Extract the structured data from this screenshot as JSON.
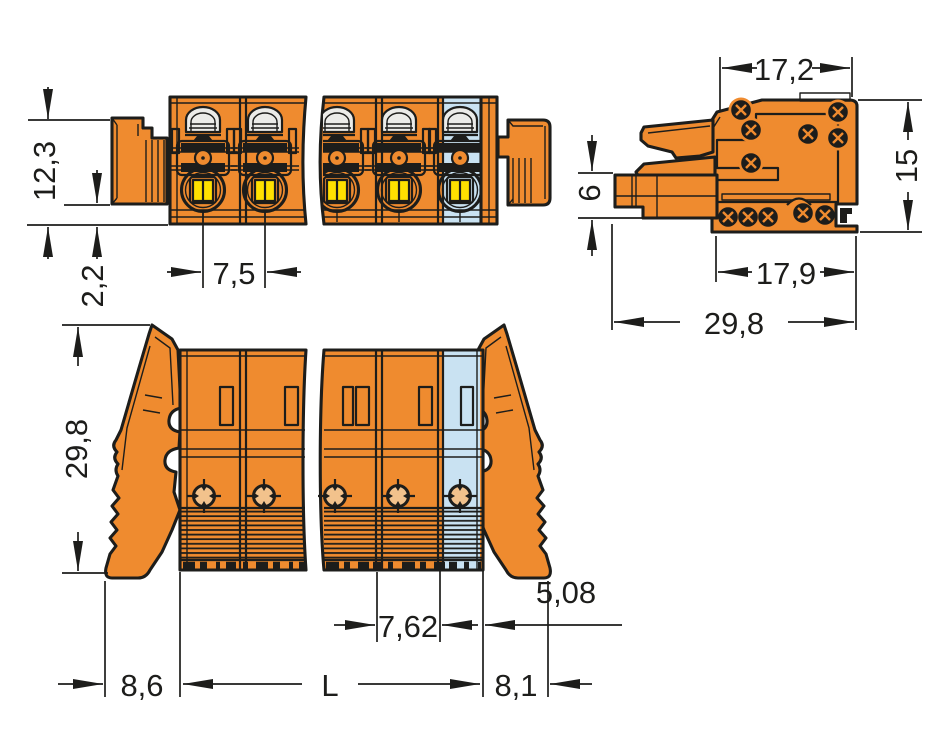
{
  "dims": {
    "top_view": {
      "plate_height": "12,3",
      "plate_overhang": "2,2",
      "pole_pitch": "7,5"
    },
    "side_view": {
      "housing_width": "17,2",
      "housing_height": "15",
      "conductor_entry": "6",
      "lower_width": "17,9",
      "total_depth": "29,8"
    },
    "front_view": {
      "total_height": "29,8",
      "end_pole_pitch": "7,62",
      "end_offset": "5,08",
      "lever_left": "8,6",
      "total_length": "L",
      "lever_right": "8,1"
    }
  },
  "colors": {
    "body": "#ef8b2f",
    "pole_special": "#c9e2f2",
    "marking": "#ffe100",
    "screw_face": "#f2c28c",
    "slot": "#ebebe8",
    "dark": "#1d1d1b",
    "background": "#ffffff"
  }
}
